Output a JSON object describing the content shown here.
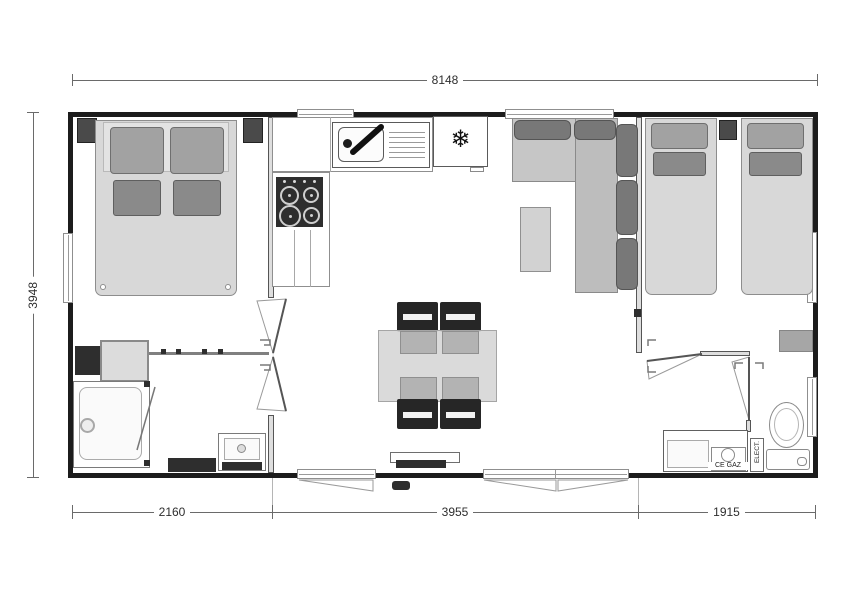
{
  "plan": {
    "type": "mobile-home floor plan, top view, grayscale architectural drawing",
    "dimensions": {
      "top_width": "8148",
      "left_height": "3948",
      "bottom_left": "2160",
      "bottom_center": "3955",
      "bottom_right": "1915"
    },
    "labels": {
      "gas_box": "CE GAZ",
      "electrical_panel": "ELECT."
    },
    "icons": {
      "freezer": "❄"
    },
    "colors": {
      "wall": "#1c1c1c",
      "dimension_line": "#6a6a6a",
      "furniture_light": "#d7d7d7",
      "furniture_mid": "#b5b5b5",
      "sofa_back": "#787878",
      "appliance_dark": "#262626",
      "text": "#2e2e2e",
      "background": "#ffffff"
    },
    "rooms_depicted": [
      "master bedroom with double bed",
      "shower room with shower, vanity and washbasin",
      "kitchen with sink, gas hob, fridge-freezer",
      "living-dining area with L-sofa, table and four chairs",
      "twin bedroom with two single beds",
      "WC with toilet, electrical panel and gas locker"
    ]
  }
}
